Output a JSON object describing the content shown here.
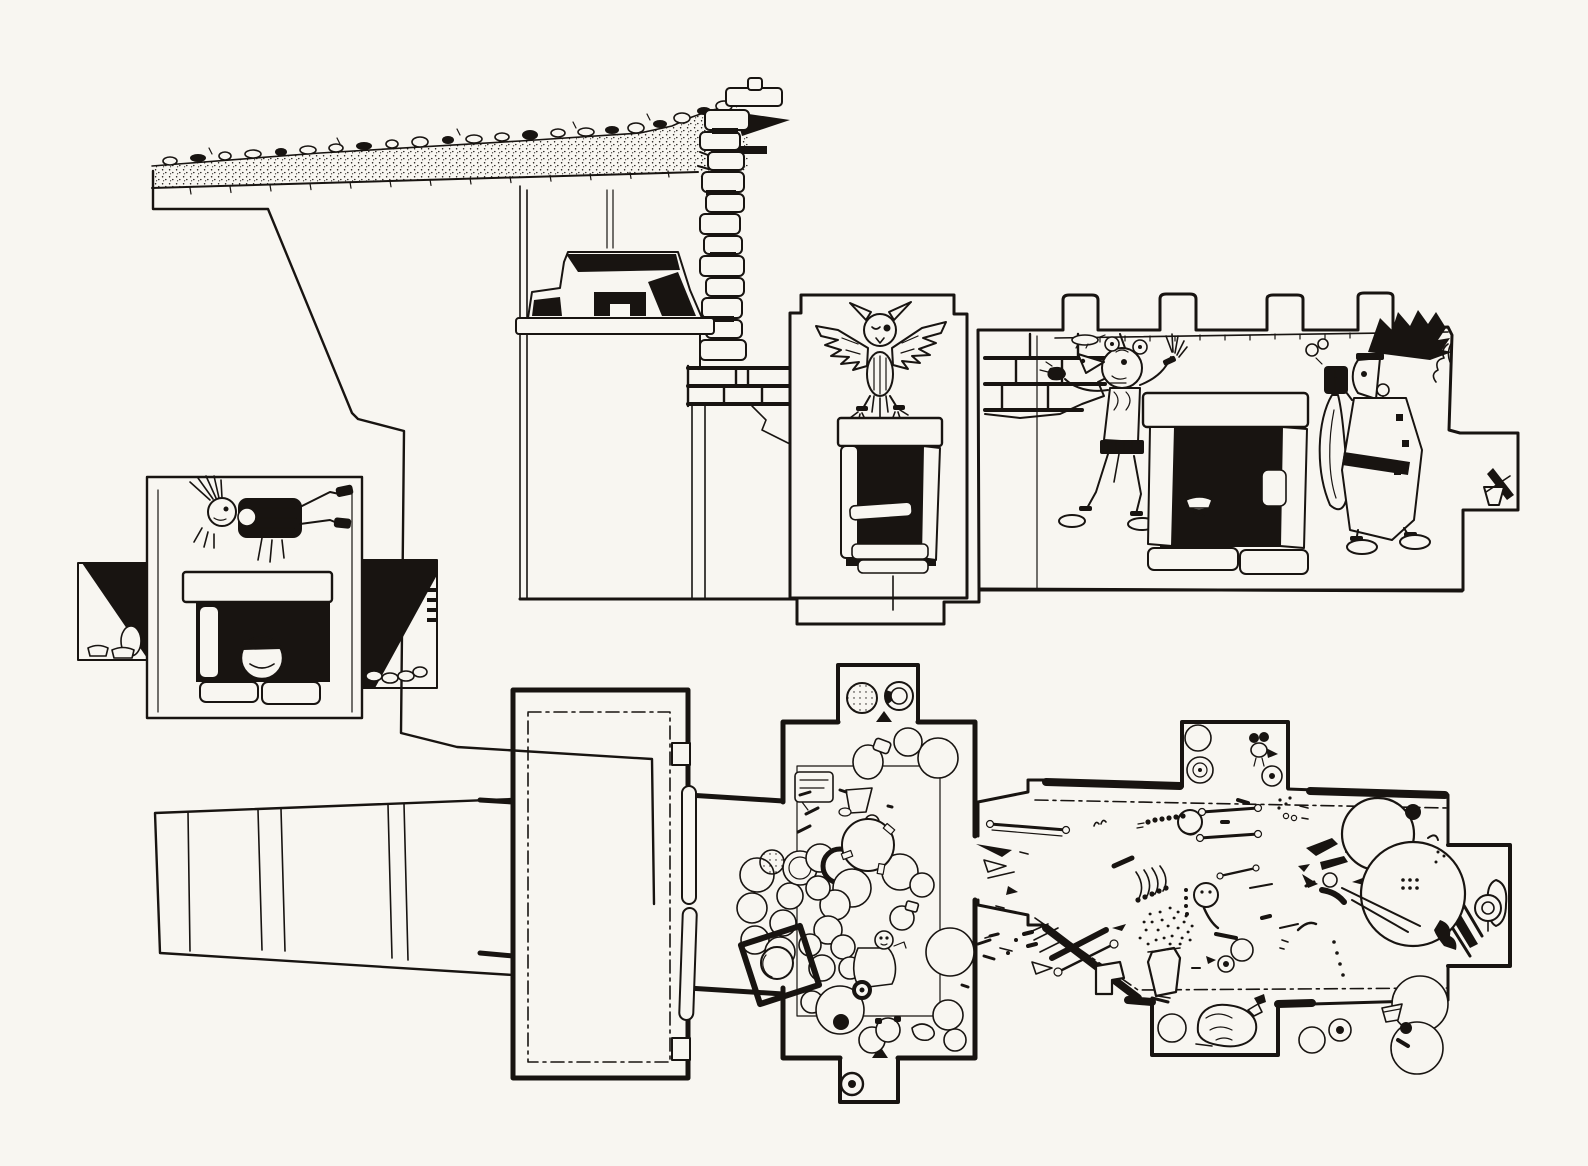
{
  "colors": {
    "paper": "#f8f6f1",
    "ink": "#181411"
  },
  "drawing": {
    "type": "archaeological-ink-line-drawing",
    "views": [
      {
        "id": "section-elevation",
        "label": "longitudinal section of mound with decorated tomb walls"
      },
      {
        "id": "facade-elevation",
        "label": "tomb facade elevation with doorway"
      },
      {
        "id": "floor-plan",
        "label": "tomb floor plan with offerings and burials"
      }
    ],
    "elevation_features": [
      "earth-mound-section",
      "surface-rubble-stones",
      "stepped-profile-cut",
      "stepped-fret-frieze",
      "masonry-block-stack",
      "brick-courses",
      "owl-mural-panel",
      "panel-niche-with-slabs",
      "crenellated-wall",
      "four-merlons",
      "animal-headdress-figure-mural",
      "wall-niche-with-bowl",
      "feather-headdress-figure-mural",
      "side-box-with-goblet"
    ],
    "facade_features": [
      "reclining-figure-mural",
      "door-lintel-slab",
      "dark-doorway",
      "jamb-slab",
      "storage-jar-in-doorway",
      "floor-slabs",
      "section-cut-dark-fills",
      "small-vessels-at-base"
    ],
    "plan_features": [
      "stepped-entrance-passage",
      "antechamber-with-dashdot-floor-line",
      "two-door-slabs",
      "offering-chamber",
      "vessel-cluster",
      "mirror-plaque",
      "north-niche-with-two-vessels",
      "south-niche-with-ring-vessel",
      "main-burial-chamber",
      "scattered-skeletal-remains",
      "large-storage-vessels",
      "north-niche-with-figurine",
      "south-niche-with-conch-shell",
      "rear-niche-with-earspool"
    ],
    "counts": {
      "merlons": 4,
      "mural-figures": 3,
      "plan-chambers": 3,
      "door-slabs": 2
    }
  }
}
